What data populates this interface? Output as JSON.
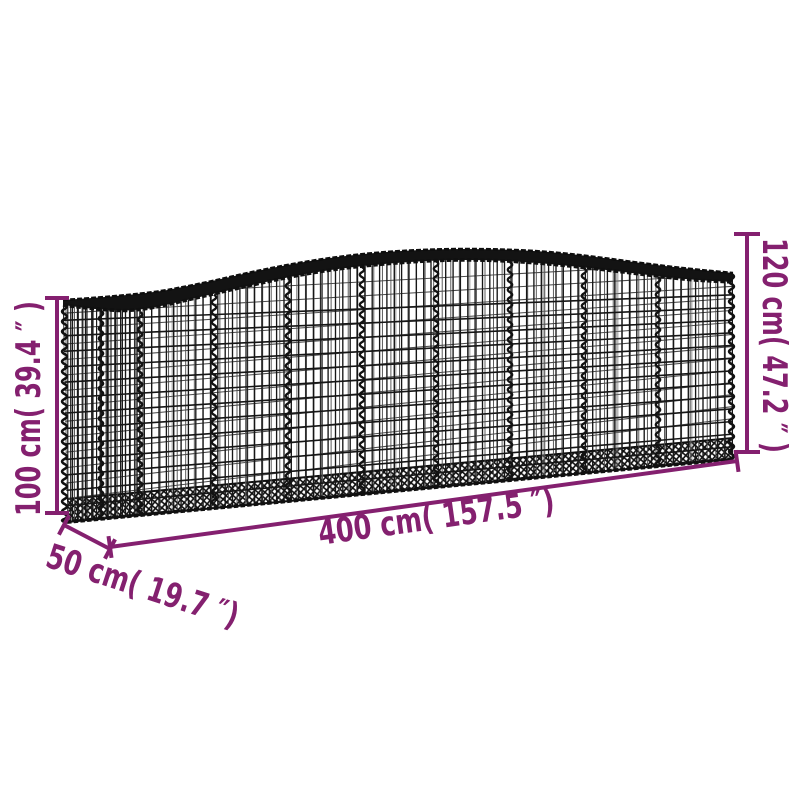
{
  "figure": {
    "type": "product-dimension-diagram",
    "subject": "Arched gabion wire mesh basket"
  },
  "colors": {
    "dimension_annotation": "#84206F",
    "wire_dark": "#161616",
    "wire_light": "#4a4a4a",
    "background": "#ffffff"
  },
  "dimension_labels": {
    "front_height": "100 cm( 39.4 ″ )",
    "arch_height": "120 cm( 47.2 ″ )",
    "length": "400 cm( 157.5 ″)",
    "depth": "50 cm( 19.7 ″)"
  }
}
